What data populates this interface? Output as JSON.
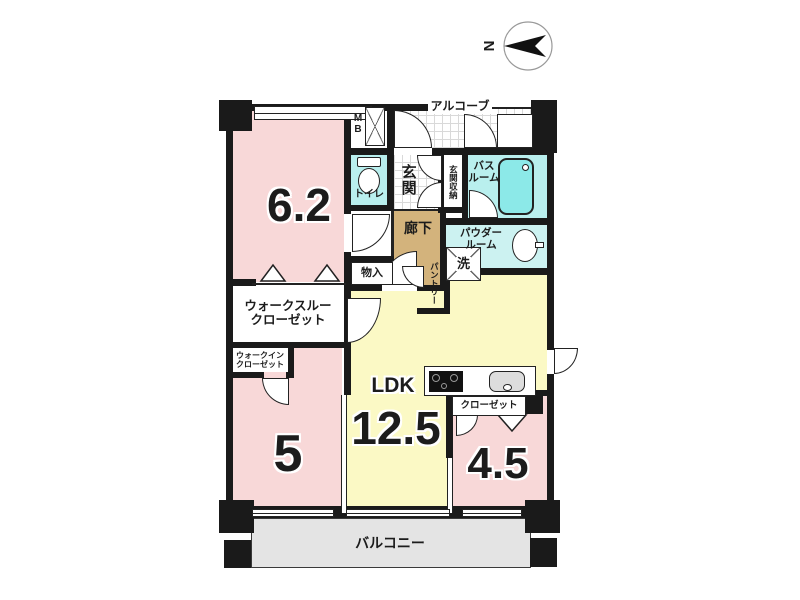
{
  "colors": {
    "wall": "#1a1a1a",
    "line": "#222222",
    "pink": "#f8d8d8",
    "yellow": "#fbf9c5",
    "cyan": "#b9efee",
    "cyanlight": "#ccf2f1",
    "tub": "#8ce9e8",
    "tan": "#d3b37c",
    "gray": "#e4e4e4"
  },
  "compass": {
    "north": "N"
  },
  "rooms": {
    "bedroom1": {
      "area": "6.2"
    },
    "bedroom2": {
      "area": "5"
    },
    "bedroom3": {
      "area": "4.5"
    },
    "ldk": {
      "name": "LDK",
      "area": "12.5"
    },
    "entrance": {
      "name": "玄関"
    },
    "entrance_storage": {
      "name": "玄関収納"
    },
    "toilet": {
      "name": "トイレ"
    },
    "bathroom": {
      "line1": "バス",
      "line2": "ルーム"
    },
    "powder_room": {
      "line1": "パウダー",
      "line2": "ルーム"
    },
    "corridor": {
      "name": "廊下"
    },
    "laundry": {
      "name": "洗"
    },
    "storage": {
      "name": "物入"
    },
    "pantry": {
      "name": "パントリー"
    },
    "walkthrough_closet": {
      "line1": "ウォークスルー",
      "line2": "クローゼット"
    },
    "walkin_closet": {
      "line1": "ウォークイン",
      "line2": "クローゼット"
    },
    "closet": {
      "name": "クローゼット"
    },
    "alcove": {
      "name": "アルコーブ"
    },
    "meter_box": {
      "line1": "M",
      "line2": "B"
    },
    "balcony": {
      "name": "バルコニー"
    }
  }
}
